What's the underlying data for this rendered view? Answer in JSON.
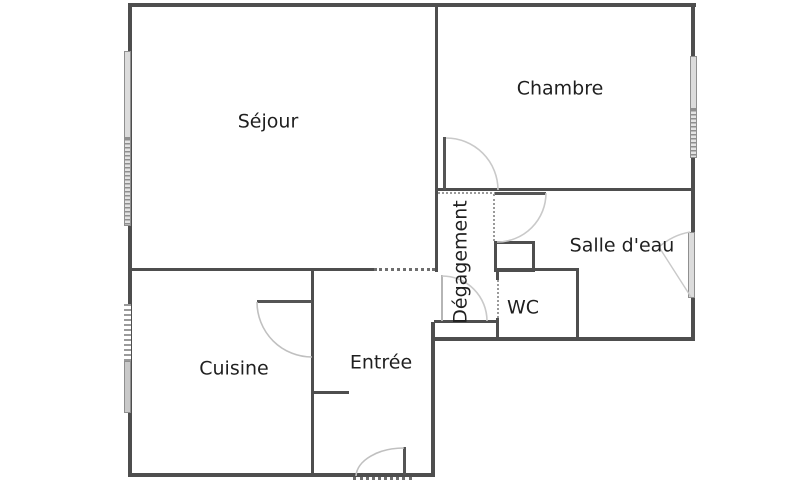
{
  "rooms": {
    "sejour": {
      "label": "Séjour"
    },
    "chambre": {
      "label": "Chambre"
    },
    "cuisine": {
      "label": "Cuisine"
    },
    "entree": {
      "label": "Entrée"
    },
    "salle_deau": {
      "label": "Salle d'eau"
    },
    "wc": {
      "label": "WC"
    },
    "degagement": {
      "label": "Dégagement"
    }
  },
  "colors": {
    "wall": "#4e4e4e",
    "window_fill": "#dcdcdc",
    "window_border": "#8f8f8f",
    "door_arc": "#c9c9c9",
    "label_text": "#1f1f1f",
    "background": "#ffffff"
  }
}
